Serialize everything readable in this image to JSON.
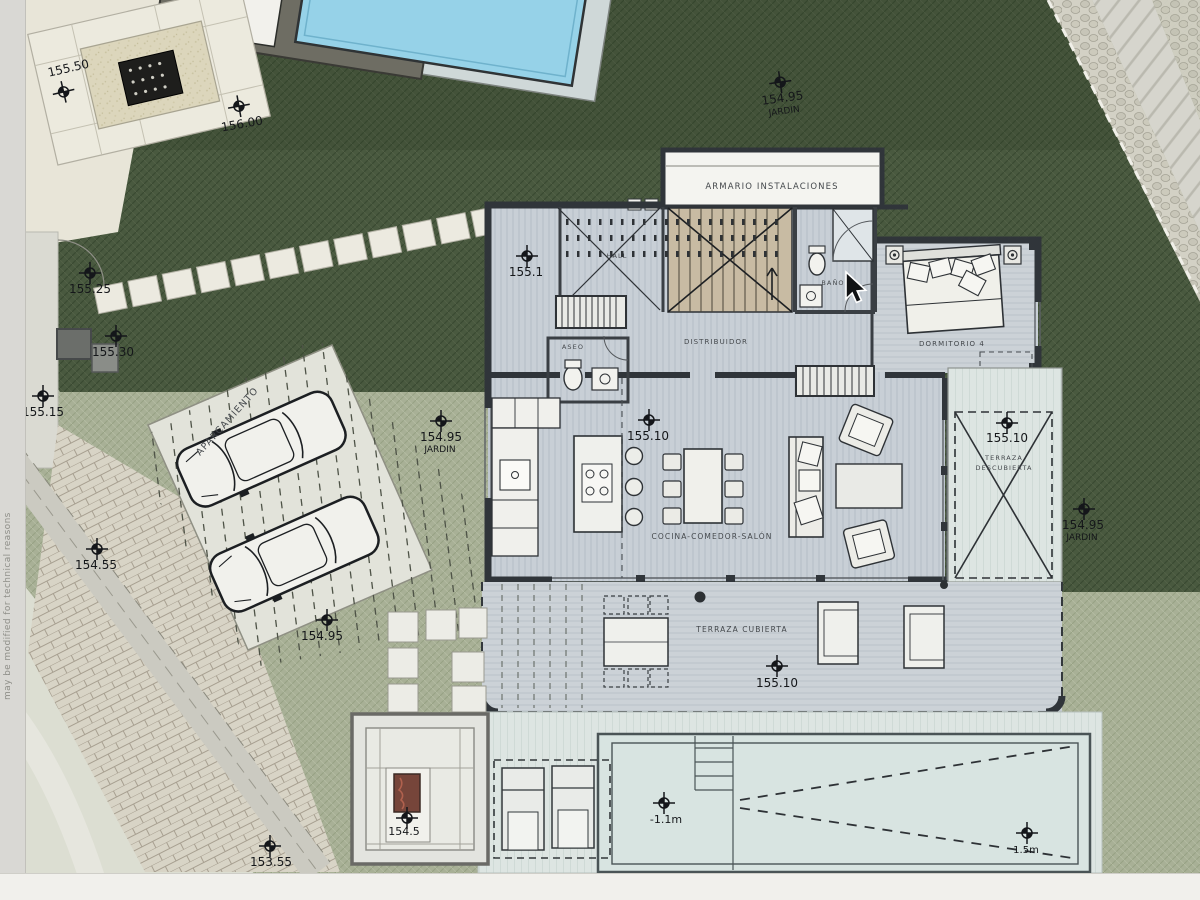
{
  "watermark": "may be modified for technical reasons",
  "rooms": {
    "armario": "ARMARIO INSTALACIONES",
    "hall": "HALL",
    "aseo": "ASEO",
    "bano": "BAÑO",
    "distribuidor": "DISTRIBUIDOR",
    "dormitorio4": "DORMITORIO 4",
    "salon": "COCINA-COMEDOR-SALÓN",
    "terraza_cubierta": "TERRAZA CUBIERTA",
    "terraza_desc_line1": "TERRAZA",
    "terraza_desc_line2": "DESCUBIERTA",
    "aparcamiento": "APARCAMIENTO"
  },
  "levels": [
    {
      "label": "155.50"
    },
    {
      "label": "156.00"
    },
    {
      "label": "154.95",
      "sub": "JARDIN"
    },
    {
      "label": "155.25"
    },
    {
      "label": "155.30"
    },
    {
      "label": "155.15"
    },
    {
      "label": "155.1"
    },
    {
      "label": "155.10"
    },
    {
      "label": "154.95",
      "sub": "JARDIN"
    },
    {
      "label": "155.10"
    },
    {
      "label": "154.95",
      "sub": "JARDIN"
    },
    {
      "label": "154.55"
    },
    {
      "label": "154.95"
    },
    {
      "label": "155.10"
    },
    {
      "label": "154.5"
    },
    {
      "label": "153.55"
    },
    {
      "label": "-1.1m"
    },
    {
      "label": "1.5m"
    }
  ],
  "colors": {
    "garden_dark": "#49593f",
    "garden_light": "#a8b096",
    "wall": "#30353a",
    "floor": "#c8cfd6",
    "pool_top_water": "#96d2e8",
    "pool_deck": "#dde5e2",
    "firepit": "#76453a",
    "paper": "#e8e5d8"
  }
}
